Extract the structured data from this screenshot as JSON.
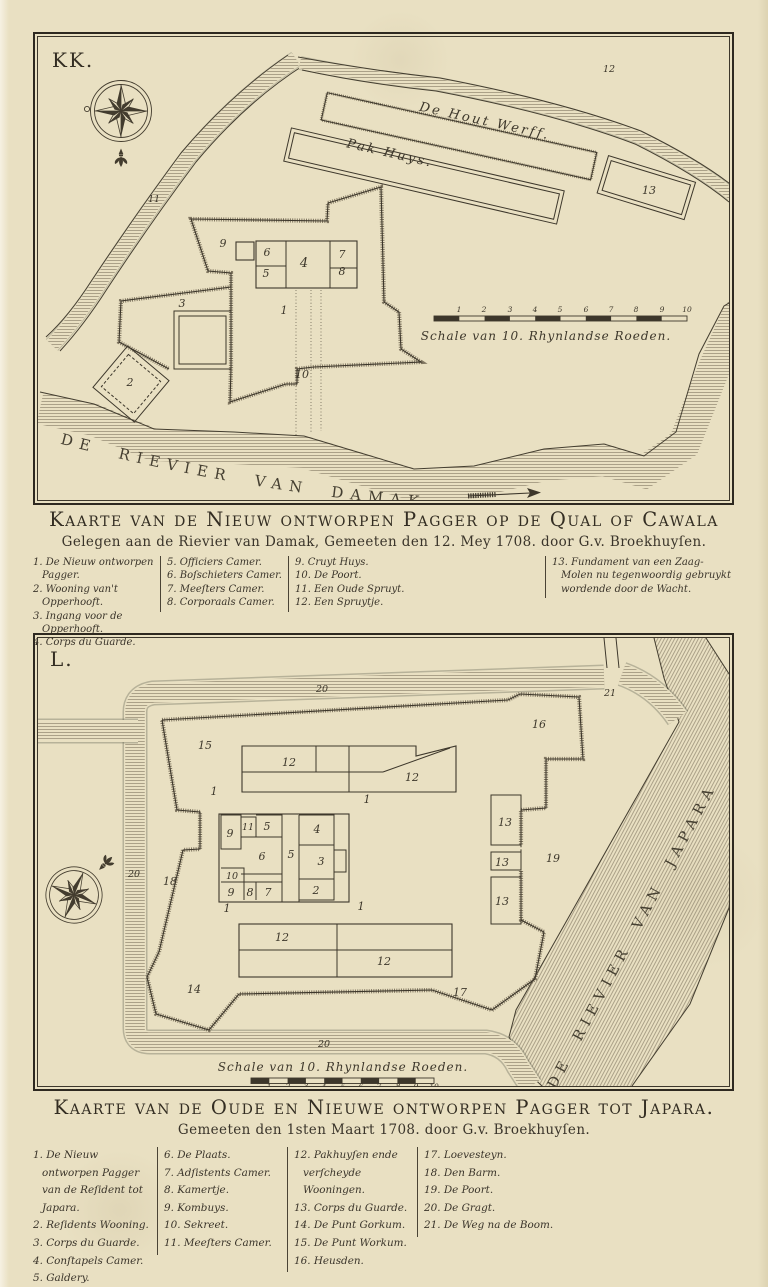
{
  "palette": {
    "paper": "#e9e0c2",
    "ink": "#3d372b",
    "river_hatch": "#8a7f68"
  },
  "map1": {
    "plate_letter": "KK.",
    "title": "Kaarte van de Nieuw ontworpen Pagger op de Qual of Cawala",
    "subtitle": "Gelegen aan de Rievier van Damak, Gemeeten den 12. Mey 1708. door G.v. Broekhuyſen.",
    "labels": {
      "hout_werff": "De Hout Werff.",
      "pak_huys": "Pak Huys.",
      "river": "DE RIEVIER VAN DAMAK.",
      "scale": "Schale van 10. Rhynlandse Roeden."
    },
    "legend_columns": [
      [
        "1. De Nieuw ontworpen Pagger.",
        "2. Wooning van't Opperhooft.",
        "3. Ingang voor de Opperhooft.",
        "4. Corps du Guarde."
      ],
      [
        "5. Officiers Camer.",
        "6. Boſschieters Camer.",
        "7. Meeſters Camer.",
        "8. Corporaals Camer."
      ],
      [
        "9. Cruyt Huys.",
        "10. De Poort.",
        "11. Een Oude Spruyt.",
        "12. Een Spruytje."
      ],
      [
        "13. Fundament van een Zaag-Molen nu tegenwoordig gebruykt wordende door de Wacht."
      ]
    ],
    "markers": [
      {
        "t": "1",
        "x": 246,
        "y": 277
      },
      {
        "t": "2",
        "x": 92,
        "y": 349
      },
      {
        "t": "3",
        "x": 144,
        "y": 270
      },
      {
        "t": "4",
        "x": 266,
        "y": 230,
        "cls": "lg"
      },
      {
        "t": "5",
        "x": 228,
        "y": 240
      },
      {
        "t": "6",
        "x": 229,
        "y": 219
      },
      {
        "t": "7",
        "x": 304,
        "y": 221
      },
      {
        "t": "8",
        "x": 304,
        "y": 238
      },
      {
        "t": "9",
        "x": 185,
        "y": 210
      },
      {
        "t": "10",
        "x": 264,
        "y": 341
      },
      {
        "t": "11",
        "x": 116,
        "y": 165,
        "cls": "sm"
      },
      {
        "t": "12",
        "x": 571,
        "y": 35,
        "cls": "sm"
      },
      {
        "t": "13",
        "x": 611,
        "y": 157
      },
      {
        "t": "1",
        "x": 421,
        "y": 275,
        "cls": "tick"
      },
      {
        "t": "2",
        "x": 446,
        "y": 275,
        "cls": "tick"
      },
      {
        "t": "3",
        "x": 472,
        "y": 275,
        "cls": "tick"
      },
      {
        "t": "4",
        "x": 497,
        "y": 275,
        "cls": "tick"
      },
      {
        "t": "5",
        "x": 522,
        "y": 275,
        "cls": "tick"
      },
      {
        "t": "6",
        "x": 548,
        "y": 275,
        "cls": "tick"
      },
      {
        "t": "7",
        "x": 573,
        "y": 275,
        "cls": "tick"
      },
      {
        "t": "8",
        "x": 598,
        "y": 275,
        "cls": "tick"
      },
      {
        "t": "9",
        "x": 624,
        "y": 275,
        "cls": "tick"
      },
      {
        "t": "10",
        "x": 649,
        "y": 275,
        "cls": "tick"
      }
    ]
  },
  "map2": {
    "plate_letter": "L.",
    "title": "Kaarte van de Oude en Nieuwe ontworpen Pagger tot Japara.",
    "subtitle": "Gemeeten den 1sten Maart 1708. door G.v. Broekhuyſen.",
    "labels": {
      "river": "DE RIEVIER VAN JAPARA",
      "scale": "Schale van 10. Rhynlandse Roeden."
    },
    "legend_columns": [
      [
        "1. De Nieuw ontworpen Pagger van de Reſident tot Japara.",
        "2. Reſidents Wooning.",
        "3. Corps du Guarde.",
        "4. Conſtapels Camer.",
        "5. Galdery."
      ],
      [
        "6. De Plaats.",
        "7. Adſistents Camer.",
        "8. Kamertje.",
        "9. Kombuys.",
        "10. Sekreet.",
        "11. Meeſters Camer."
      ],
      [
        "12. Pakhuyſen ende verſcheyde Wooningen.",
        "13. Corps du Guarde.",
        "14. De Punt Gorkum.",
        "15. De Punt Workum.",
        "16. Heusden."
      ],
      [
        "17. Loevesteyn.",
        "18. Den Barm.",
        "19. De Poort.",
        "20. De Gragt.",
        "21. De Weg na de Boom."
      ]
    ],
    "markers": [
      {
        "t": "15",
        "x": 167,
        "y": 111
      },
      {
        "t": "12",
        "x": 251,
        "y": 128
      },
      {
        "t": "12",
        "x": 374,
        "y": 143
      },
      {
        "t": "16",
        "x": 501,
        "y": 90
      },
      {
        "t": "1",
        "x": 176,
        "y": 157
      },
      {
        "t": "1",
        "x": 329,
        "y": 165
      },
      {
        "t": "9",
        "x": 192,
        "y": 199
      },
      {
        "t": "11",
        "x": 210,
        "y": 192,
        "cls": "sm"
      },
      {
        "t": "5",
        "x": 229,
        "y": 192
      },
      {
        "t": "4",
        "x": 279,
        "y": 195
      },
      {
        "t": "6",
        "x": 224,
        "y": 222
      },
      {
        "t": "5",
        "x": 253,
        "y": 220
      },
      {
        "t": "3",
        "x": 283,
        "y": 227
      },
      {
        "t": "13",
        "x": 467,
        "y": 188
      },
      {
        "t": "13",
        "x": 464,
        "y": 228
      },
      {
        "t": "19",
        "x": 515,
        "y": 224
      },
      {
        "t": "10",
        "x": 194,
        "y": 241,
        "cls": "sm"
      },
      {
        "t": "9",
        "x": 193,
        "y": 258
      },
      {
        "t": "8",
        "x": 212,
        "y": 258
      },
      {
        "t": "7",
        "x": 230,
        "y": 258
      },
      {
        "t": "2",
        "x": 278,
        "y": 256
      },
      {
        "t": "13",
        "x": 464,
        "y": 267
      },
      {
        "t": "18",
        "x": 132,
        "y": 247
      },
      {
        "t": "20",
        "x": 96,
        "y": 239,
        "cls": "sm"
      },
      {
        "t": "20",
        "x": 284,
        "y": 54,
        "cls": "sm"
      },
      {
        "t": "20",
        "x": 286,
        "y": 409,
        "cls": "sm"
      },
      {
        "t": "21",
        "x": 572,
        "y": 58,
        "cls": "sm"
      },
      {
        "t": "1",
        "x": 189,
        "y": 274
      },
      {
        "t": "1",
        "x": 323,
        "y": 272
      },
      {
        "t": "12",
        "x": 244,
        "y": 303
      },
      {
        "t": "12",
        "x": 346,
        "y": 327
      },
      {
        "t": "14",
        "x": 156,
        "y": 355
      },
      {
        "t": "17",
        "x": 422,
        "y": 358
      },
      {
        "t": "1",
        "x": 231,
        "y": 451,
        "cls": "tick"
      },
      {
        "t": "2",
        "x": 250,
        "y": 451,
        "cls": "tick"
      },
      {
        "t": "3",
        "x": 268,
        "y": 451,
        "cls": "tick"
      },
      {
        "t": "4",
        "x": 286,
        "y": 451,
        "cls": "tick"
      },
      {
        "t": "5",
        "x": 305,
        "y": 451,
        "cls": "tick"
      },
      {
        "t": "6",
        "x": 323,
        "y": 451,
        "cls": "tick"
      },
      {
        "t": "7",
        "x": 341,
        "y": 451,
        "cls": "tick"
      },
      {
        "t": "8",
        "x": 360,
        "y": 451,
        "cls": "tick"
      },
      {
        "t": "9",
        "x": 378,
        "y": 451,
        "cls": "tick"
      },
      {
        "t": "10",
        "x": 396,
        "y": 451,
        "cls": "tick"
      }
    ]
  }
}
